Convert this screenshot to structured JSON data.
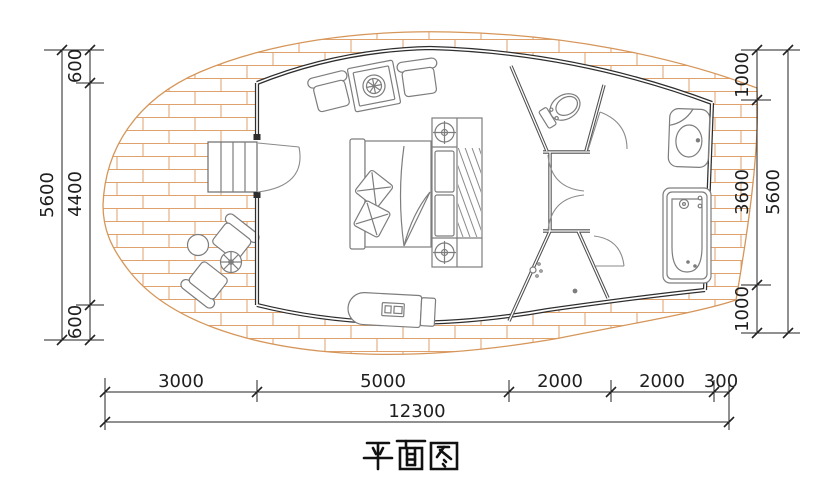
{
  "title": {
    "text": "平面图"
  },
  "colors": {
    "background": "#ffffff",
    "outer_wall": "#2e2e2e",
    "partition_wall": "#505050",
    "deck_brick_line": "#dfa26d",
    "deck_edge": "#d6965a",
    "furniture_line": "#7d7d7d",
    "dimension_line": "#222222"
  },
  "dimensions": {
    "left": {
      "overall": "5600",
      "segments": [
        "600",
        "4400",
        "600"
      ]
    },
    "right": {
      "overall": "5600",
      "segments": [
        "1000",
        "3600",
        "1000"
      ]
    },
    "bottom": {
      "overall": "12300",
      "segments": [
        "3000",
        "5000",
        "2000",
        "2000",
        "300"
      ]
    }
  },
  "fixtures": [
    "wood-deck",
    "entry-steps",
    "entry-door",
    "outdoor-chair",
    "outdoor-round-table",
    "outdoor-stool",
    "armchair",
    "tea-table",
    "double-bed",
    "pillow",
    "blanket",
    "wardrobe",
    "hanging-clothes",
    "ceiling-lamp",
    "storage-bench",
    "toilet-room",
    "toilet",
    "interior-door",
    "shower-room",
    "shower-head",
    "floor-drain",
    "shower-door",
    "vanity-sink",
    "bathtub"
  ]
}
